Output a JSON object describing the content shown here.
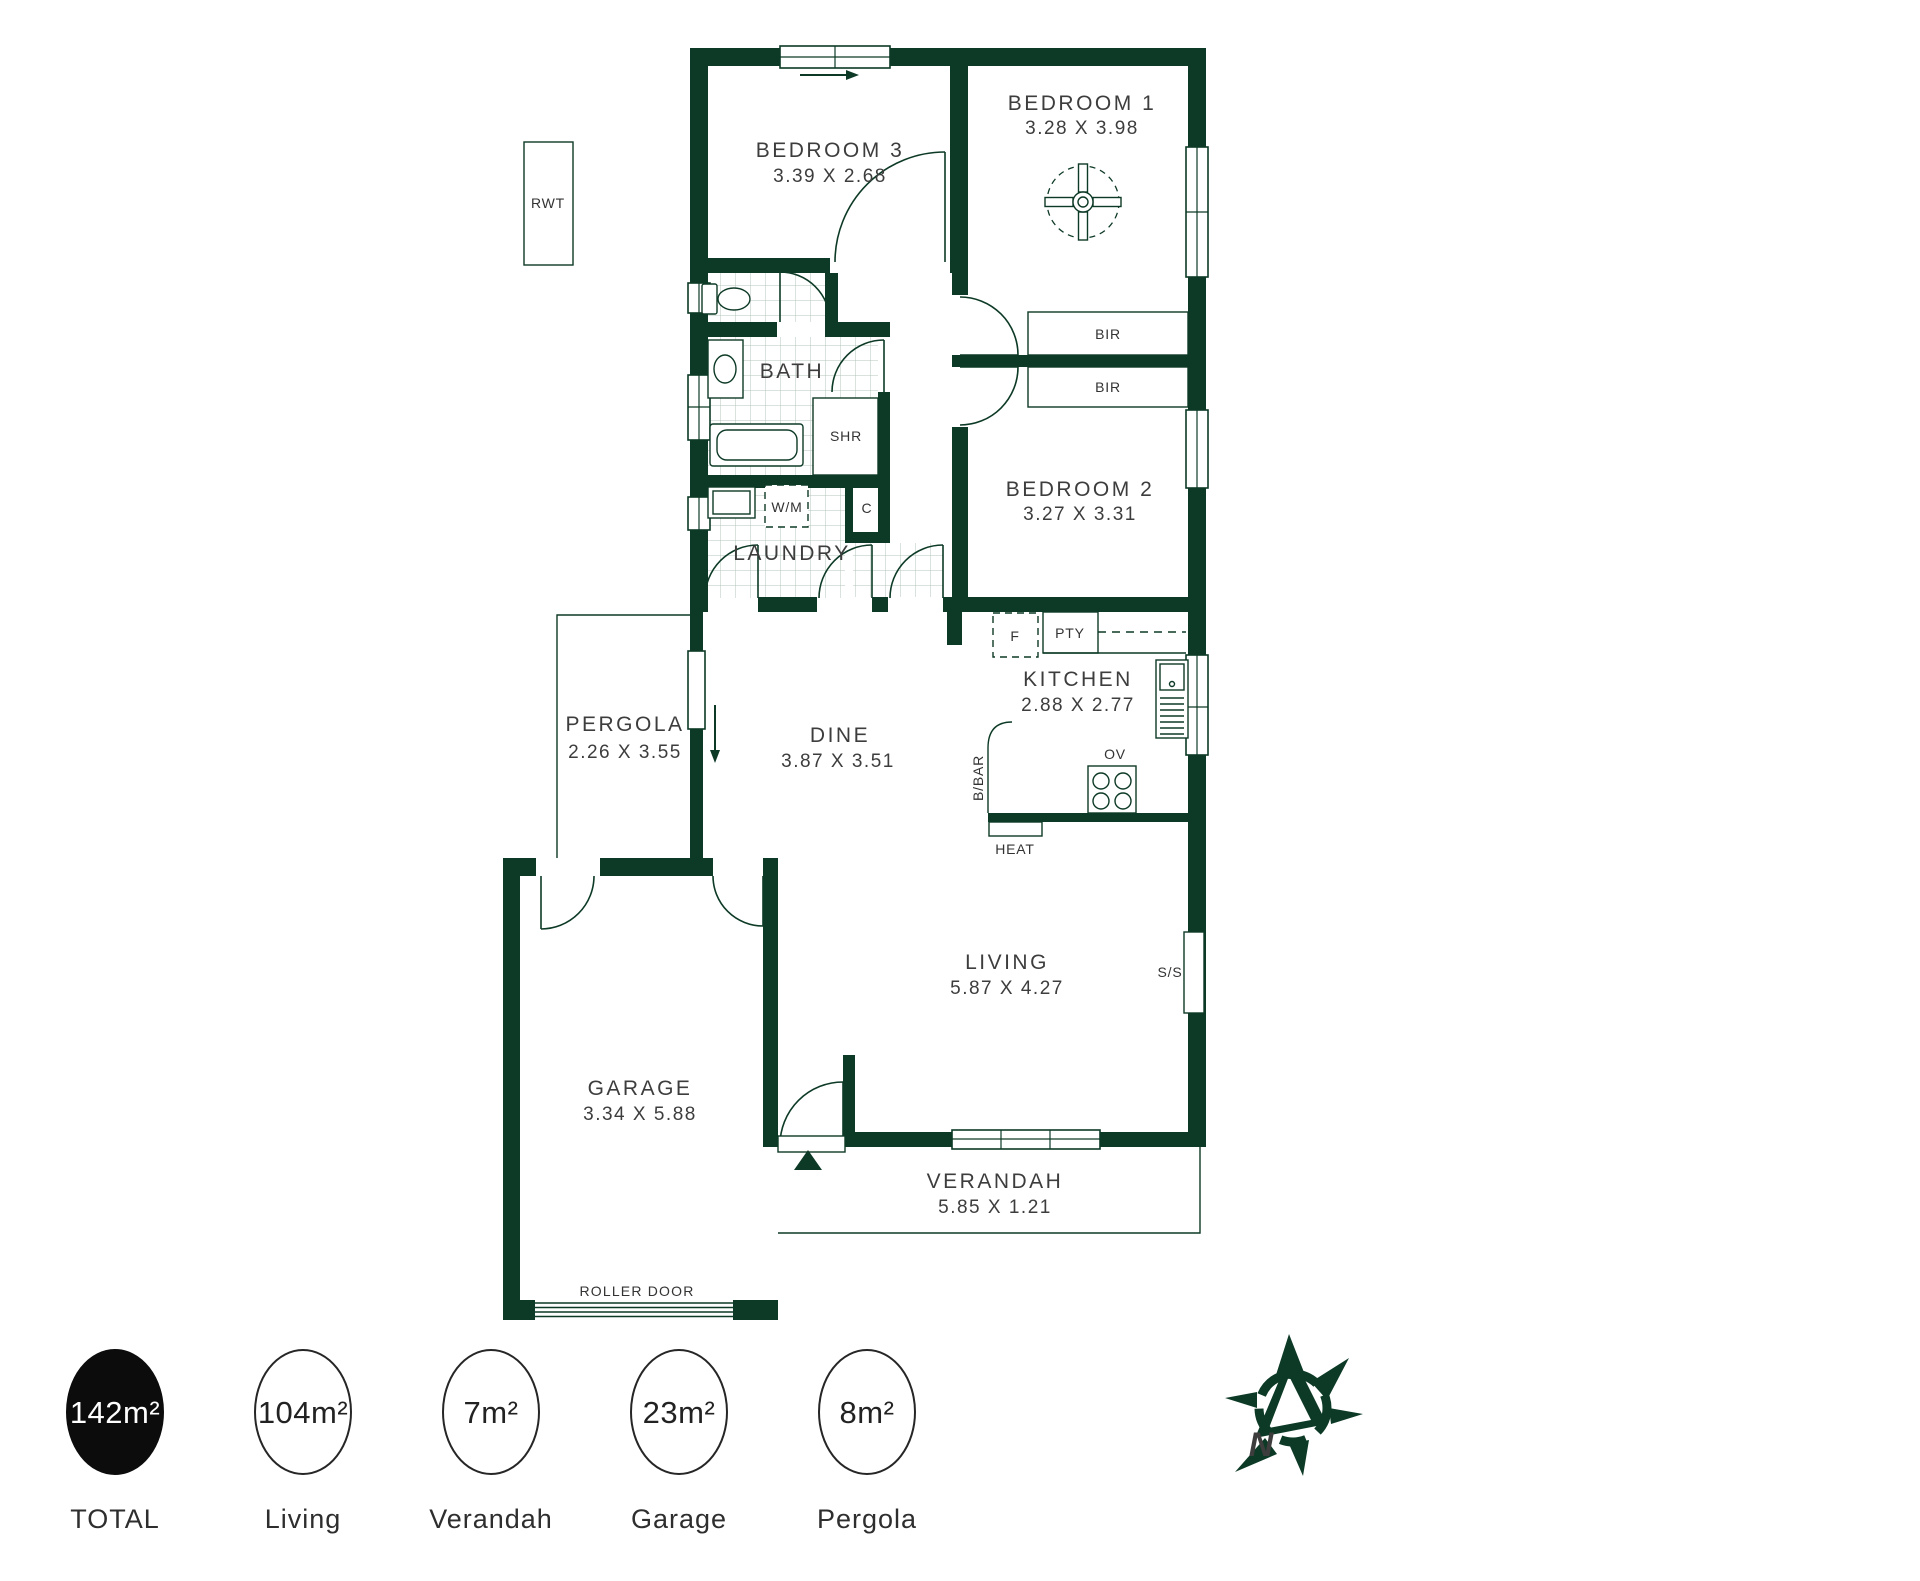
{
  "rooms": {
    "bedroom1": {
      "name": "BEDROOM 1",
      "dims": "3.28 X 3.98"
    },
    "bedroom2": {
      "name": "BEDROOM 2",
      "dims": "3.27 X 3.31"
    },
    "bedroom3": {
      "name": "BEDROOM 3",
      "dims": "3.39 X 2.68"
    },
    "bath": {
      "name": "BATH"
    },
    "laundry": {
      "name": "LAUNDRY"
    },
    "kitchen": {
      "name": "KITCHEN",
      "dims": "2.88 X 2.77"
    },
    "dine": {
      "name": "DINE",
      "dims": "3.87 X 3.51"
    },
    "living": {
      "name": "LIVING",
      "dims": "5.87 X 4.27"
    },
    "pergola": {
      "name": "PERGOLA",
      "dims": "2.26 X 3.55"
    },
    "garage": {
      "name": "GARAGE",
      "dims": "3.34 X 5.88"
    },
    "verandah": {
      "name": "VERANDAH",
      "dims": "5.85 X 1.21"
    }
  },
  "fixtures": {
    "rwt": "RWT",
    "bir": "BIR",
    "shr": "SHR",
    "wm": "W/M",
    "cupboard": "C",
    "fridge": "F",
    "pantry": "PTY",
    "oven": "OV",
    "breakfast_bar": "B/BAR",
    "heater": "HEAT",
    "side_server": "S/S",
    "roller_door": "ROLLER DOOR"
  },
  "compass": {
    "letter": "N"
  },
  "summary": [
    {
      "value": "142m²",
      "label": "TOTAL"
    },
    {
      "value": "104m²",
      "label": "Living"
    },
    {
      "value": "7m²",
      "label": "Verandah"
    },
    {
      "value": "23m²",
      "label": "Garage"
    },
    {
      "value": "8m²",
      "label": "Pergola"
    }
  ],
  "colors": {
    "wall": "#0d3a26",
    "label": "#3d3d3d",
    "total_fill": "#0c0c0c"
  }
}
